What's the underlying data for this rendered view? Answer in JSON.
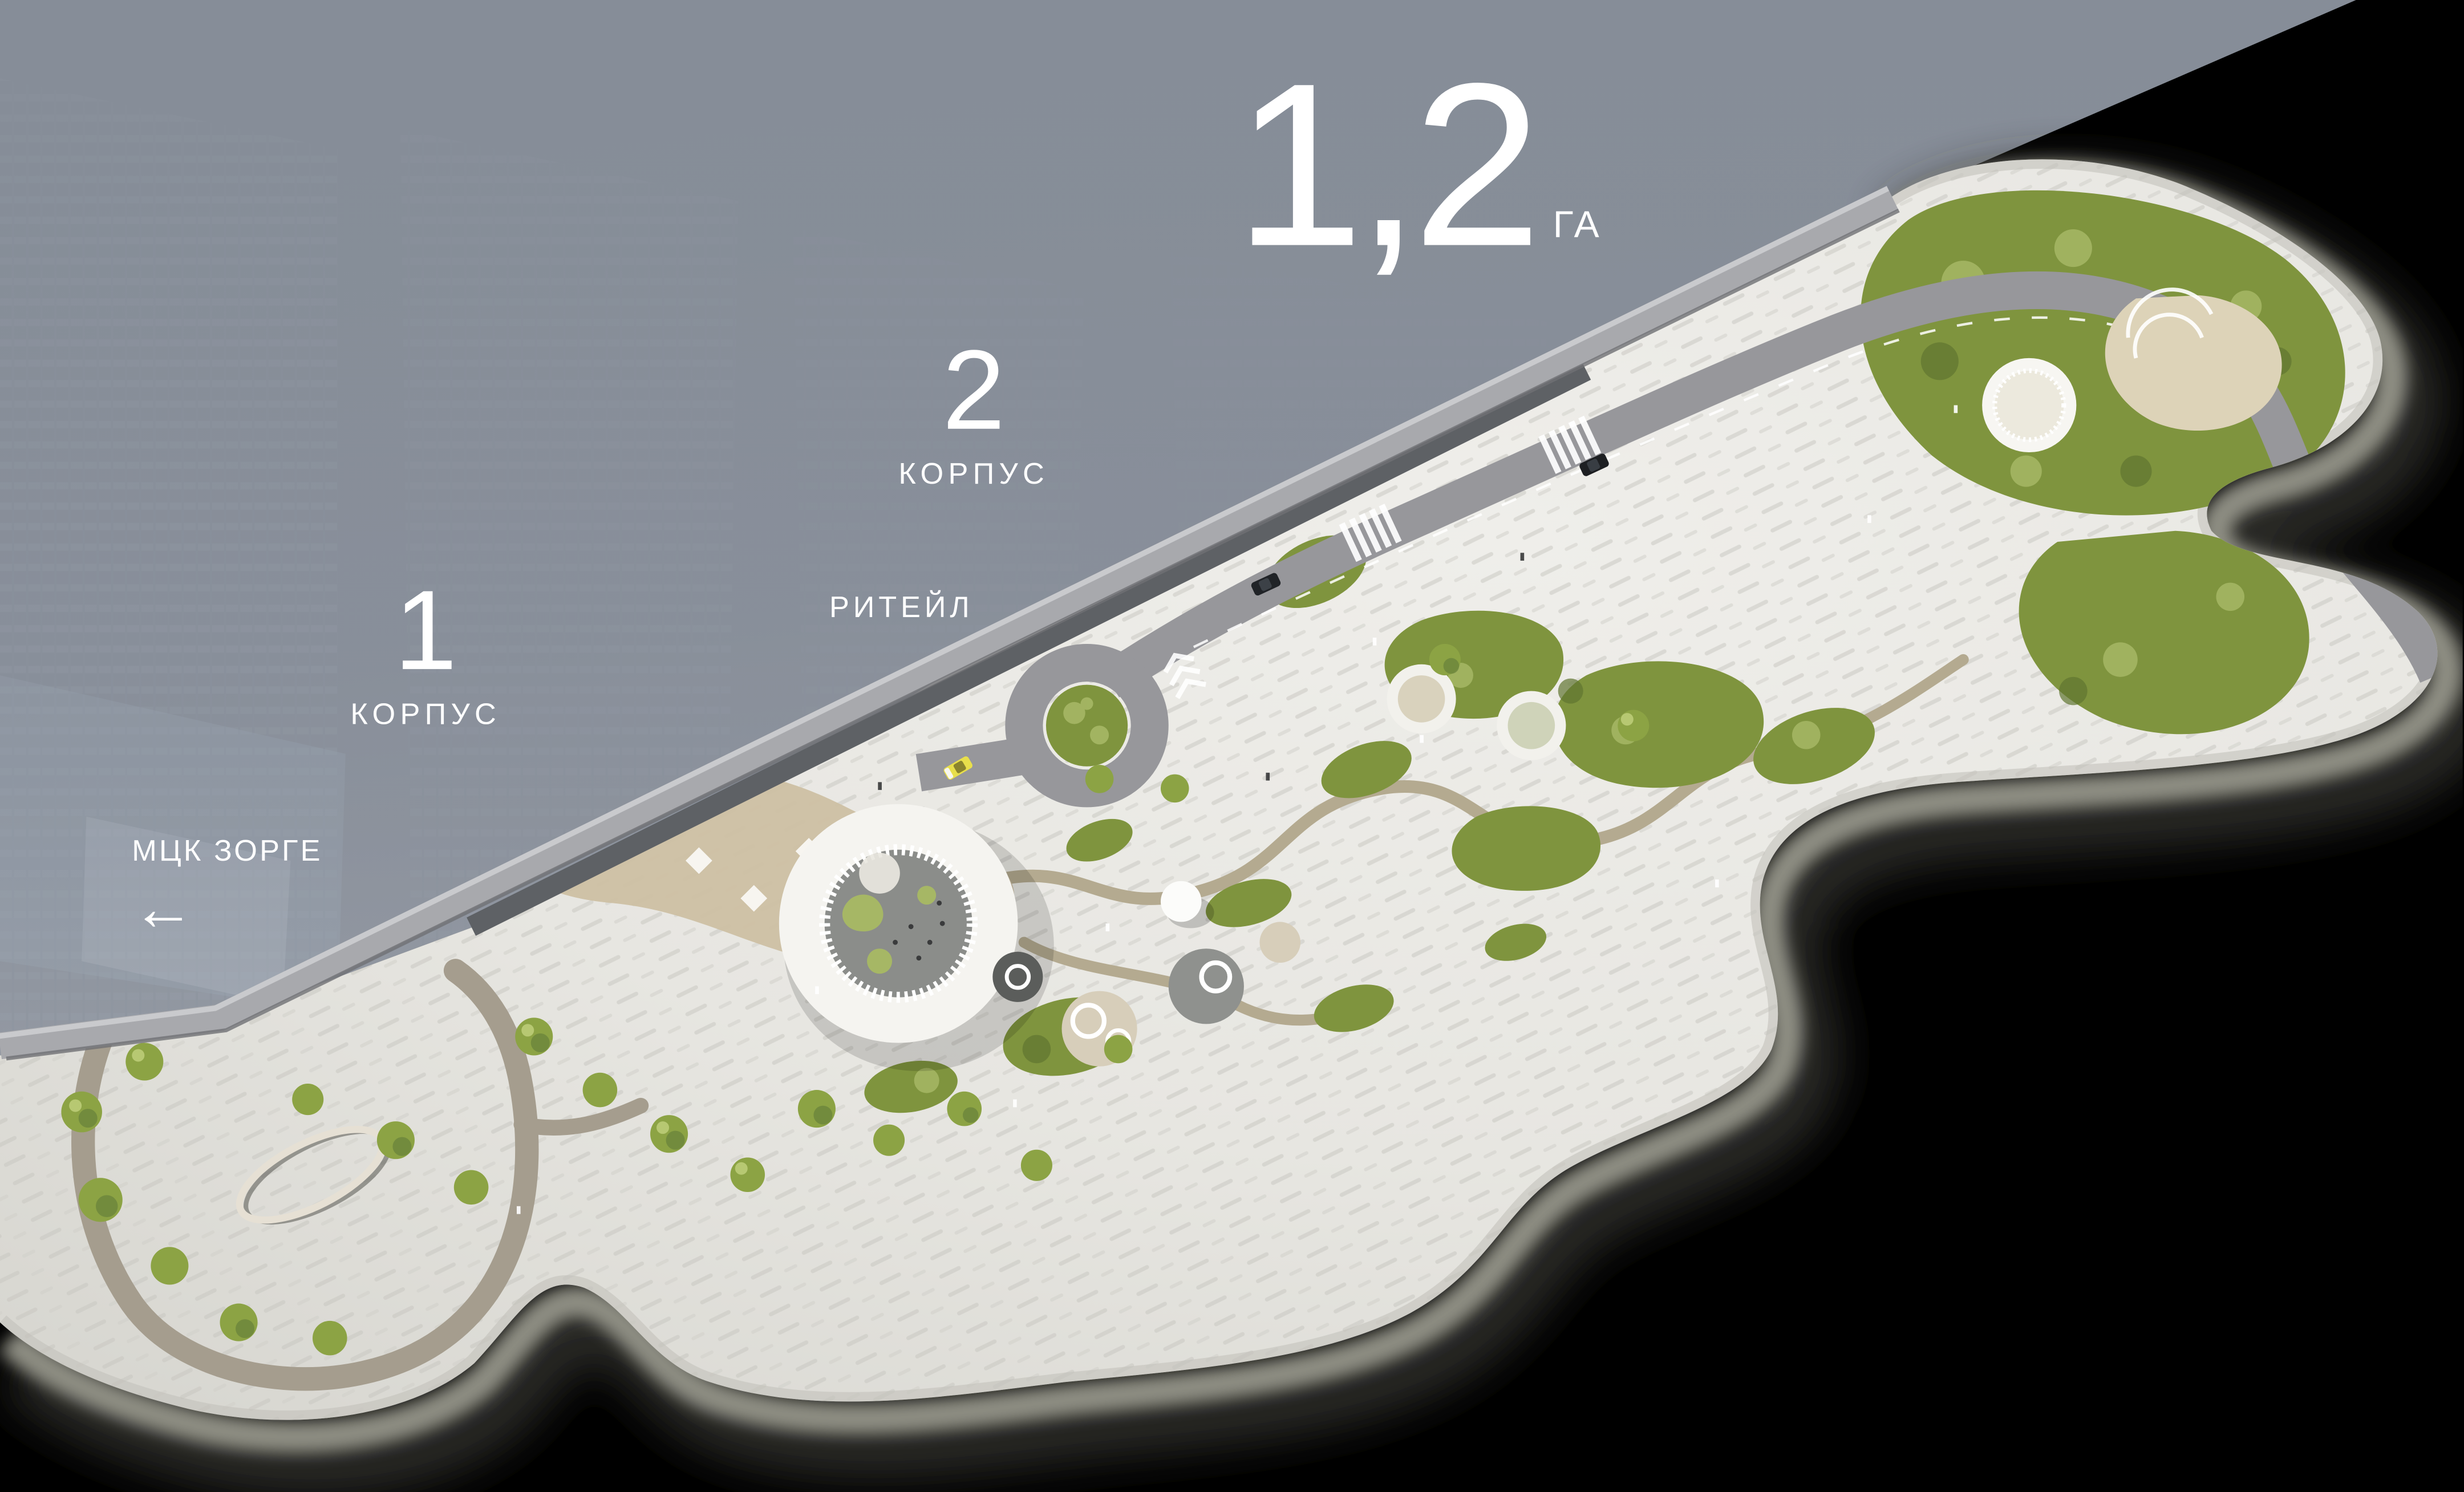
{
  "scene": {
    "kind": "residential-masterplan-render"
  },
  "labels": {
    "area": {
      "value": "1,2",
      "unit": "ГА"
    },
    "building_2": {
      "number": "2",
      "label": "КОРПУС"
    },
    "building_1": {
      "number": "1",
      "label": "КОРПУС"
    },
    "retail": {
      "label": "РИТЕЙЛ"
    },
    "transit": {
      "label": "МЦК ЗОРГЕ",
      "arrow": "←"
    }
  },
  "colors": {
    "background": "#000000",
    "fog": "#878e99",
    "pavement": "#e8e7e3",
    "road": "#97979b",
    "greenery": "#7f943e",
    "greenery_light": "#a6b765",
    "greenery_dark": "#5f7530",
    "path_tan": "#b4aa90",
    "loop_path": "#a59d8e",
    "canopy_white": "#f5f4f0",
    "courtyard_gray": "#8b8d8a",
    "terrace_beige": "#cec0a3",
    "taxi_yellow": "#e8df4b",
    "slab_edge": "#a8a9ad",
    "glass_band": "#5e6165",
    "text": "#ffffff"
  }
}
